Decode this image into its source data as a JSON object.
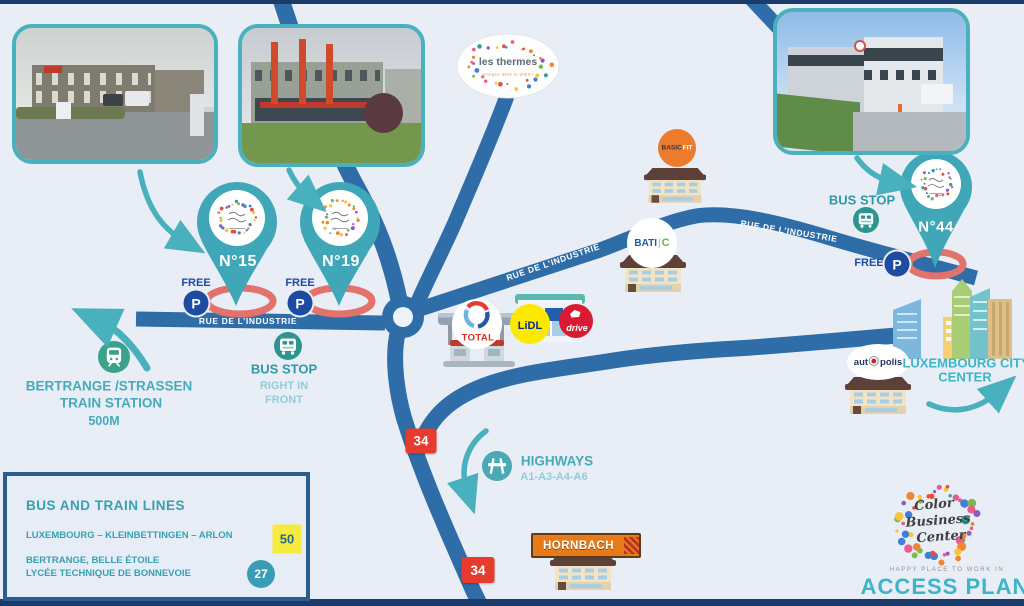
{
  "roads": {
    "street_name": "RUE DE L’INDUSTRIE"
  },
  "pins": {
    "n15": "N°15",
    "n19": "N°19",
    "n44": "N°44"
  },
  "parking": {
    "free_label": "FREE",
    "p": "P"
  },
  "bus_stop_center": {
    "title": "BUS STOP",
    "line1": "RIGHT IN",
    "line2": "FRONT"
  },
  "bus_stop_n44": {
    "title": "BUS STOP"
  },
  "train_station": {
    "line1": "BERTRANGE /STRASSEN",
    "line2": "TRAIN STATION",
    "line3": "500M"
  },
  "highways": {
    "title": "HIGHWAYS",
    "subtitle": "A1-A3-A4-A6"
  },
  "road_signs": {
    "n34": "34"
  },
  "city": {
    "line1": "LUXEMBOURG CITY",
    "line2": "CENTER"
  },
  "legend": {
    "title": "BUS AND TRAIN LINES",
    "rows": [
      {
        "label": "LUXEMBOURG – KLEINBETTINGEN – ARLON",
        "badge": "50",
        "type": "train"
      },
      {
        "label_line1": "BERTRANGE, BELLE ÉTOILE",
        "label_line2": "LYCÉE TECHNIQUE DE BONNEVOIE",
        "badge": "27",
        "type": "bus"
      }
    ]
  },
  "brand": {
    "name_line1": "Color",
    "name_line2": "Business",
    "name_line3": "Center",
    "tagline": "HAPPY PLACE TO WORK IN",
    "title": "ACCESS PLAN"
  },
  "stores": {
    "les_thermes": {
      "name": "les thermes",
      "subtitle": "plongez dans le plaisir"
    },
    "basic_fit": {
      "part1": "BASIC",
      "part2": "FIT"
    },
    "bati_c": {
      "part1": "BATI",
      "part2": "C"
    },
    "total": "TOTAL",
    "lidl": "LiDL",
    "drive": "drive",
    "autopolis": {
      "part1": "aut",
      "part2": "polis"
    },
    "hornbach": "HORNBACH"
  },
  "colors": {
    "road": "#2e6da8",
    "teal": "#46adbc",
    "navy": "#1c4ba0",
    "red_sign": "#e73b2d",
    "accent": "#3cb5c9"
  }
}
